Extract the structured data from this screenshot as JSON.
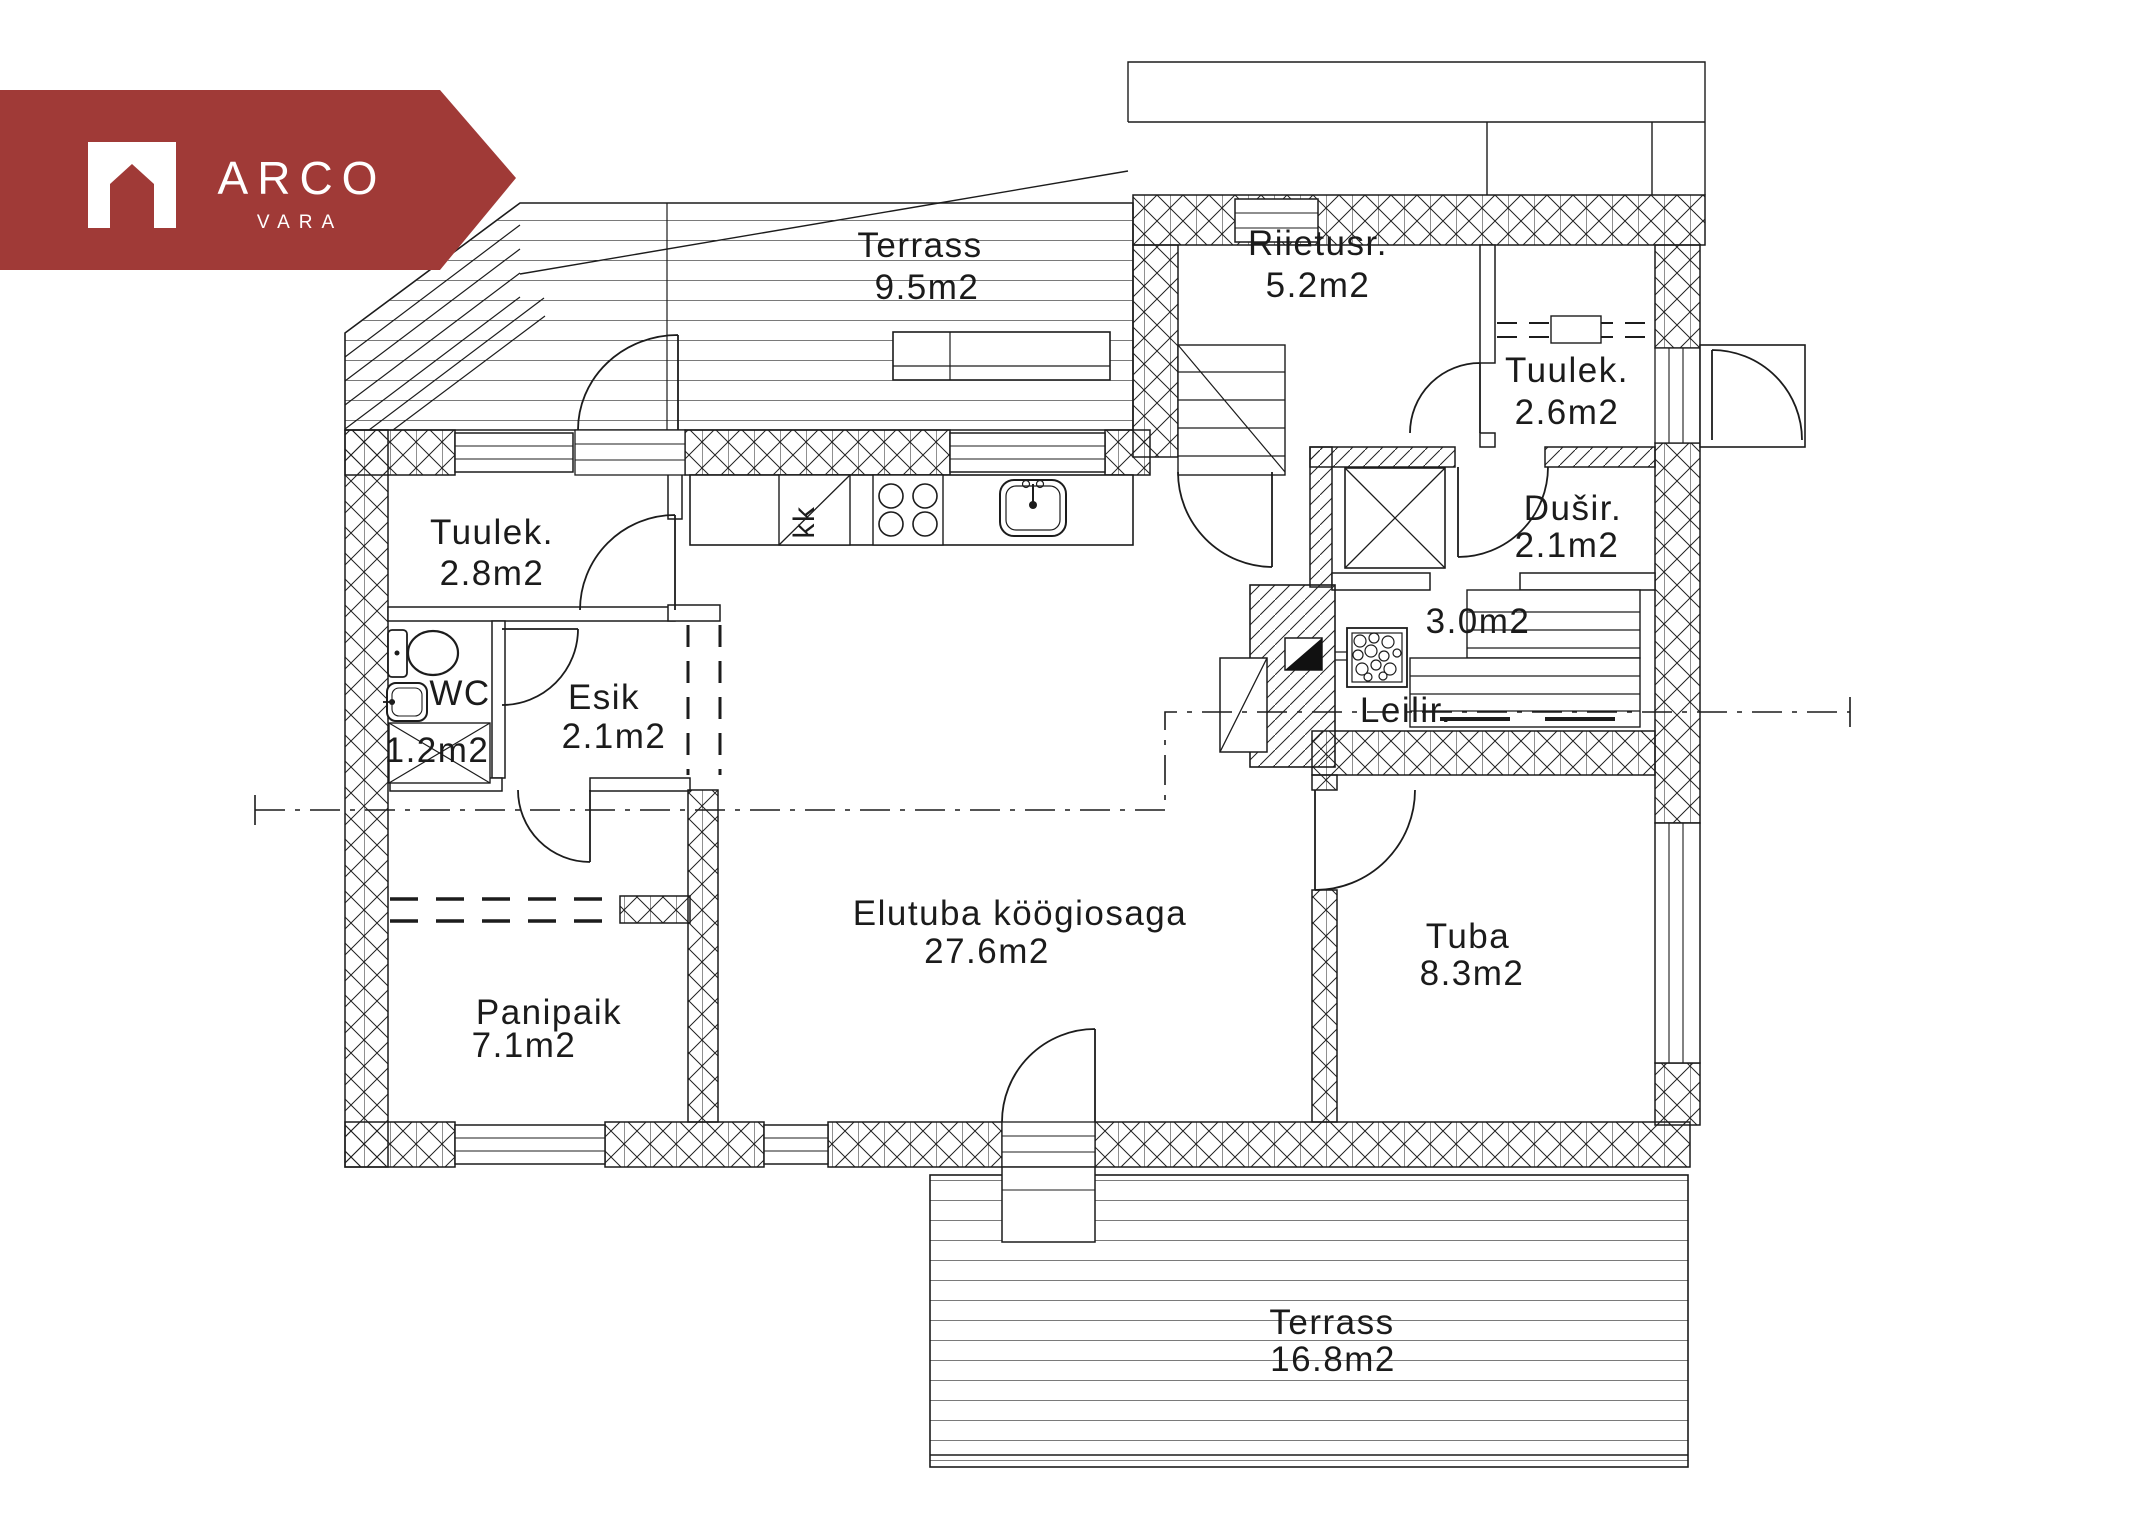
{
  "page": {
    "background": "#ffffff",
    "line_color": "#1c1c1c"
  },
  "logo": {
    "brand": "ARCO",
    "sub": "VARA",
    "color": "#a03a37",
    "text_color": "#ffffff"
  },
  "rooms": {
    "terrass_top": {
      "name": "Terrass",
      "area": "9.5m2"
    },
    "riietusr": {
      "name": "Riietusr.",
      "area": "5.2m2"
    },
    "tuulek_right": {
      "name": "Tuulek.",
      "area": "2.6m2"
    },
    "dusir": {
      "name": "Dušir.",
      "area": "2.1m2"
    },
    "leilir": {
      "name": "Leilir.",
      "area": "3.0m2"
    },
    "tuulek_left": {
      "name": "Tuulek.",
      "area": "2.8m2"
    },
    "wc": {
      "name": "WC",
      "area": "1.2m2"
    },
    "esik": {
      "name": "Esik",
      "area": "2.1m2"
    },
    "elutuba": {
      "name": "Elutuba köögiosaga",
      "area": "27.6m2"
    },
    "tuba": {
      "name": "Tuba",
      "area": "8.3m2"
    },
    "panipaik": {
      "name": "Panipaik",
      "area": "7.1m2"
    },
    "terrass_bottom": {
      "name": "Terrass",
      "area": "16.8m2"
    }
  },
  "annotations": {
    "kitchen_cabinet": "kk"
  }
}
